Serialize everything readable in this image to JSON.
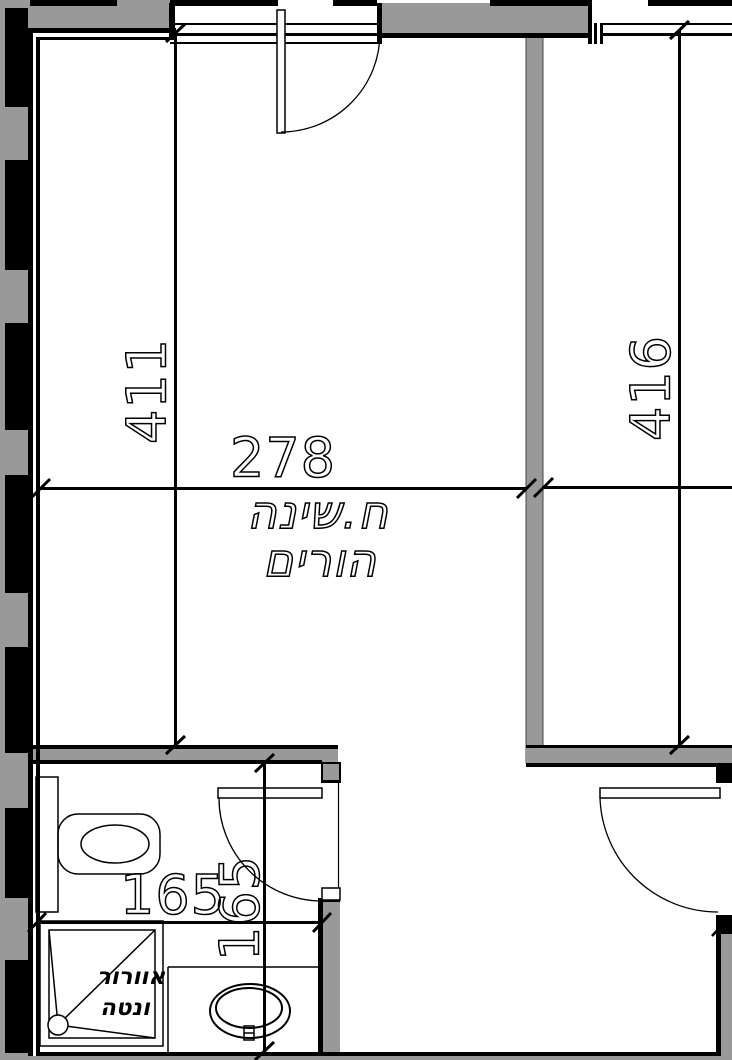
{
  "drawing": {
    "type": "architectural-floor-plan",
    "colors": {
      "wall_fill": "#999999",
      "line": "#000000",
      "background": "#ffffff"
    },
    "rooms": {
      "master_bedroom": {
        "label_line1": "ח.שינה",
        "label_line2": "הורים",
        "width_dim": "278",
        "height_dim": "411"
      },
      "adjacent_room": {
        "height_dim": "416"
      },
      "bathroom": {
        "width_dim": "165",
        "height_dim": "165",
        "shower_note_line1": "אוורור",
        "shower_note_line2": "ונטה"
      }
    }
  }
}
